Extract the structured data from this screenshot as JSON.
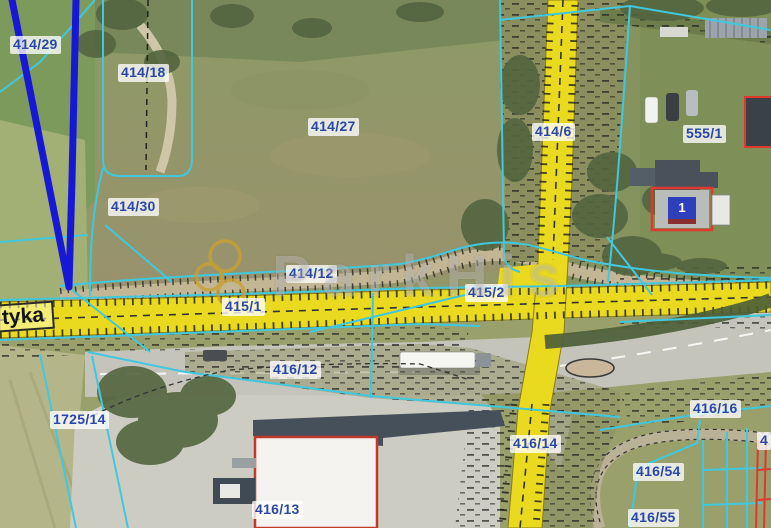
{
  "map": {
    "street_label": {
      "text": "tyka"
    },
    "building_badge": {
      "text": "1"
    },
    "watermark": {
      "text": "ParkHis",
      "logo": "three-rings-icon",
      "logo_color": "#c9a032"
    },
    "colors": {
      "parcel_line": "#3fc8de",
      "road_parcel_fill": "#e9d91f",
      "label_text": "#2a47a8",
      "ownership_line": "#1718d6",
      "building_outline": "#e0382e"
    },
    "parcel_labels": [
      {
        "text": "414/29"
      },
      {
        "text": "414/18"
      },
      {
        "text": "414/27"
      },
      {
        "text": "414/30"
      },
      {
        "text": "414/6"
      },
      {
        "text": "555/1"
      },
      {
        "text": "414/12"
      },
      {
        "text": "415/1"
      },
      {
        "text": "415/2"
      },
      {
        "text": "416/12"
      },
      {
        "text": "1725/14"
      },
      {
        "text": "416/13"
      },
      {
        "text": "416/14"
      },
      {
        "text": "416/16"
      },
      {
        "text": "416/54"
      },
      {
        "text": "416/55"
      },
      {
        "text": "4"
      }
    ]
  }
}
